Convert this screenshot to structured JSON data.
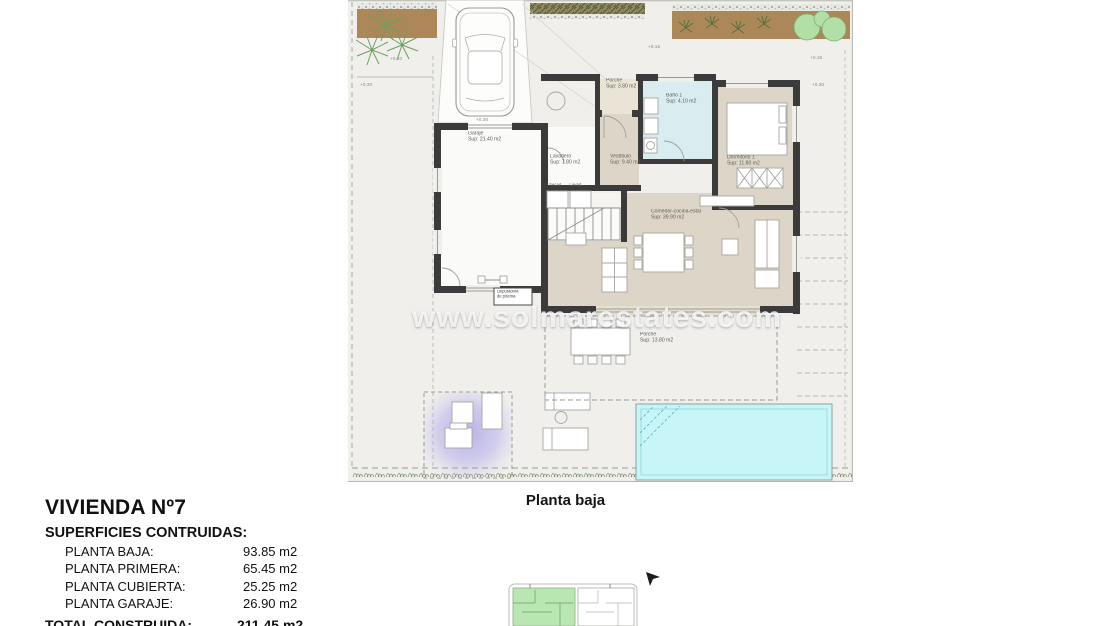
{
  "watermark": "www.solmarestates.com",
  "caption": "Planta baja",
  "title_block": {
    "title": "VIVIENDA Nº7",
    "subtitle": "SUPERFICIES CONTRUIDAS:",
    "rows": [
      {
        "label": "PLANTA BAJA:",
        "value": "93.85 m2"
      },
      {
        "label": "PLANTA PRIMERA:",
        "value": "65.45 m2"
      },
      {
        "label": "PLANTA CUBIERTA:",
        "value": "25.25 m2"
      },
      {
        "label": "PLANTA GARAJE:",
        "value": "26.90 m2"
      }
    ],
    "total": {
      "label": "TOTAL CONSTRUIDA:",
      "value": "211.45 m2"
    }
  },
  "rooms": {
    "garaje": {
      "name": "Garaje",
      "area": "Sup: 21.40 m2"
    },
    "porche_entrada": {
      "name": "Porche",
      "area": "Sup: 3.80 m2"
    },
    "bano1": {
      "name": "Baño 1",
      "area": "Sup: 4.10 m2"
    },
    "dormitorio1": {
      "name": "Dormitorio 1",
      "area": "Sup: 11.80 m2"
    },
    "lavadero": {
      "name": "Lavadero",
      "area": "Sup: 7.80 m2"
    },
    "vestibulo": {
      "name": "Vestíbulo",
      "area": "Sup: 9.40 m2"
    },
    "comedor": {
      "name": "Comedor-cocina-estar",
      "area": "Sup: 39.90 m2"
    },
    "porche_terraza": {
      "name": "Porche",
      "area": "Sup: 13.80 m2"
    },
    "depuradora": {
      "line1": "Depuradora",
      "line2": "de piscina"
    },
    "secadora": "Secad.",
    "lavadora": "Lavad."
  },
  "levels": {
    "l1": "+0.40",
    "l2": "+0.30",
    "l3": "+0.30",
    "l4": "+0.15",
    "l5": "+0.15",
    "l6": "+0.30"
  },
  "colors": {
    "wall": "#3b3b3b",
    "room_beige": "#ddd6c8",
    "bath_blue": "#d9edf0",
    "pool": "#c8f6f8",
    "garden_soil": "#ac8758",
    "tree_green": "#b2dfa6",
    "pergola_purple": "#7f74e2",
    "keyplan_green": "#b9e7b1",
    "paving": "#f0efec"
  }
}
